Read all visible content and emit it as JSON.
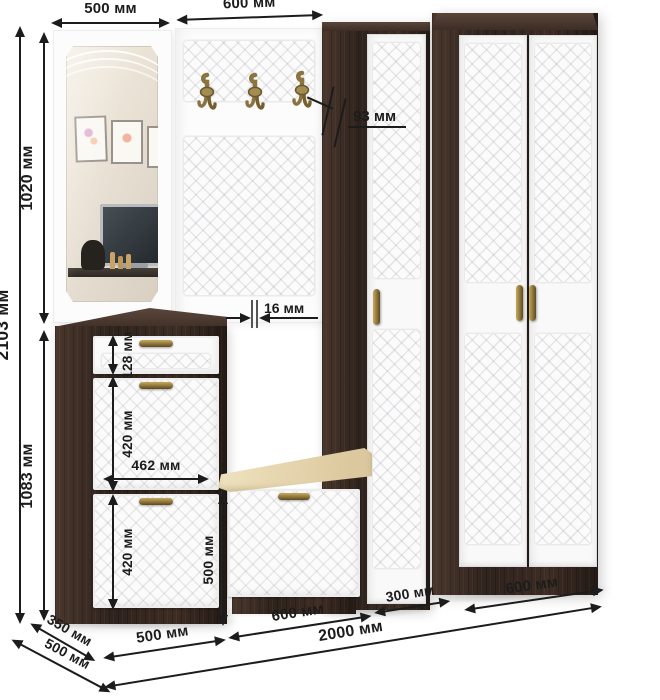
{
  "labels": {
    "top_mirror_width": "500 мм",
    "top_hook_panel_width": "600 мм",
    "total_height": "2103 мм",
    "mirror_section_height": "1020 мм",
    "cabinet_section_height": "1083 мм",
    "hook_depth": "93 мм",
    "panel_thickness": "16 мм",
    "drawer_front_height": "128 мм",
    "upper_flap_height": "420 мм",
    "flap_front_width": "462 мм",
    "lower_flap_height": "420 мм",
    "bench_height": "500 мм",
    "shoe_cabinet_width": "500 мм",
    "bench_width": "600 мм",
    "narrow_wardrobe_width": "300 мм",
    "wardrobe_width": "600 мм",
    "total_width": "2000 мм",
    "shoe_cabinet_depth": "350 мм",
    "wardrobe_depth": "500 мм"
  },
  "colors": {
    "dimension_ink": "#1c1c1c",
    "wenge_dark": "#2e231d",
    "wenge_light": "#5a453a",
    "door_white": "#fafafa",
    "cushion_cream": "#eadcb8",
    "handle_bronze": "#8a7038",
    "background": "#ffffff"
  }
}
